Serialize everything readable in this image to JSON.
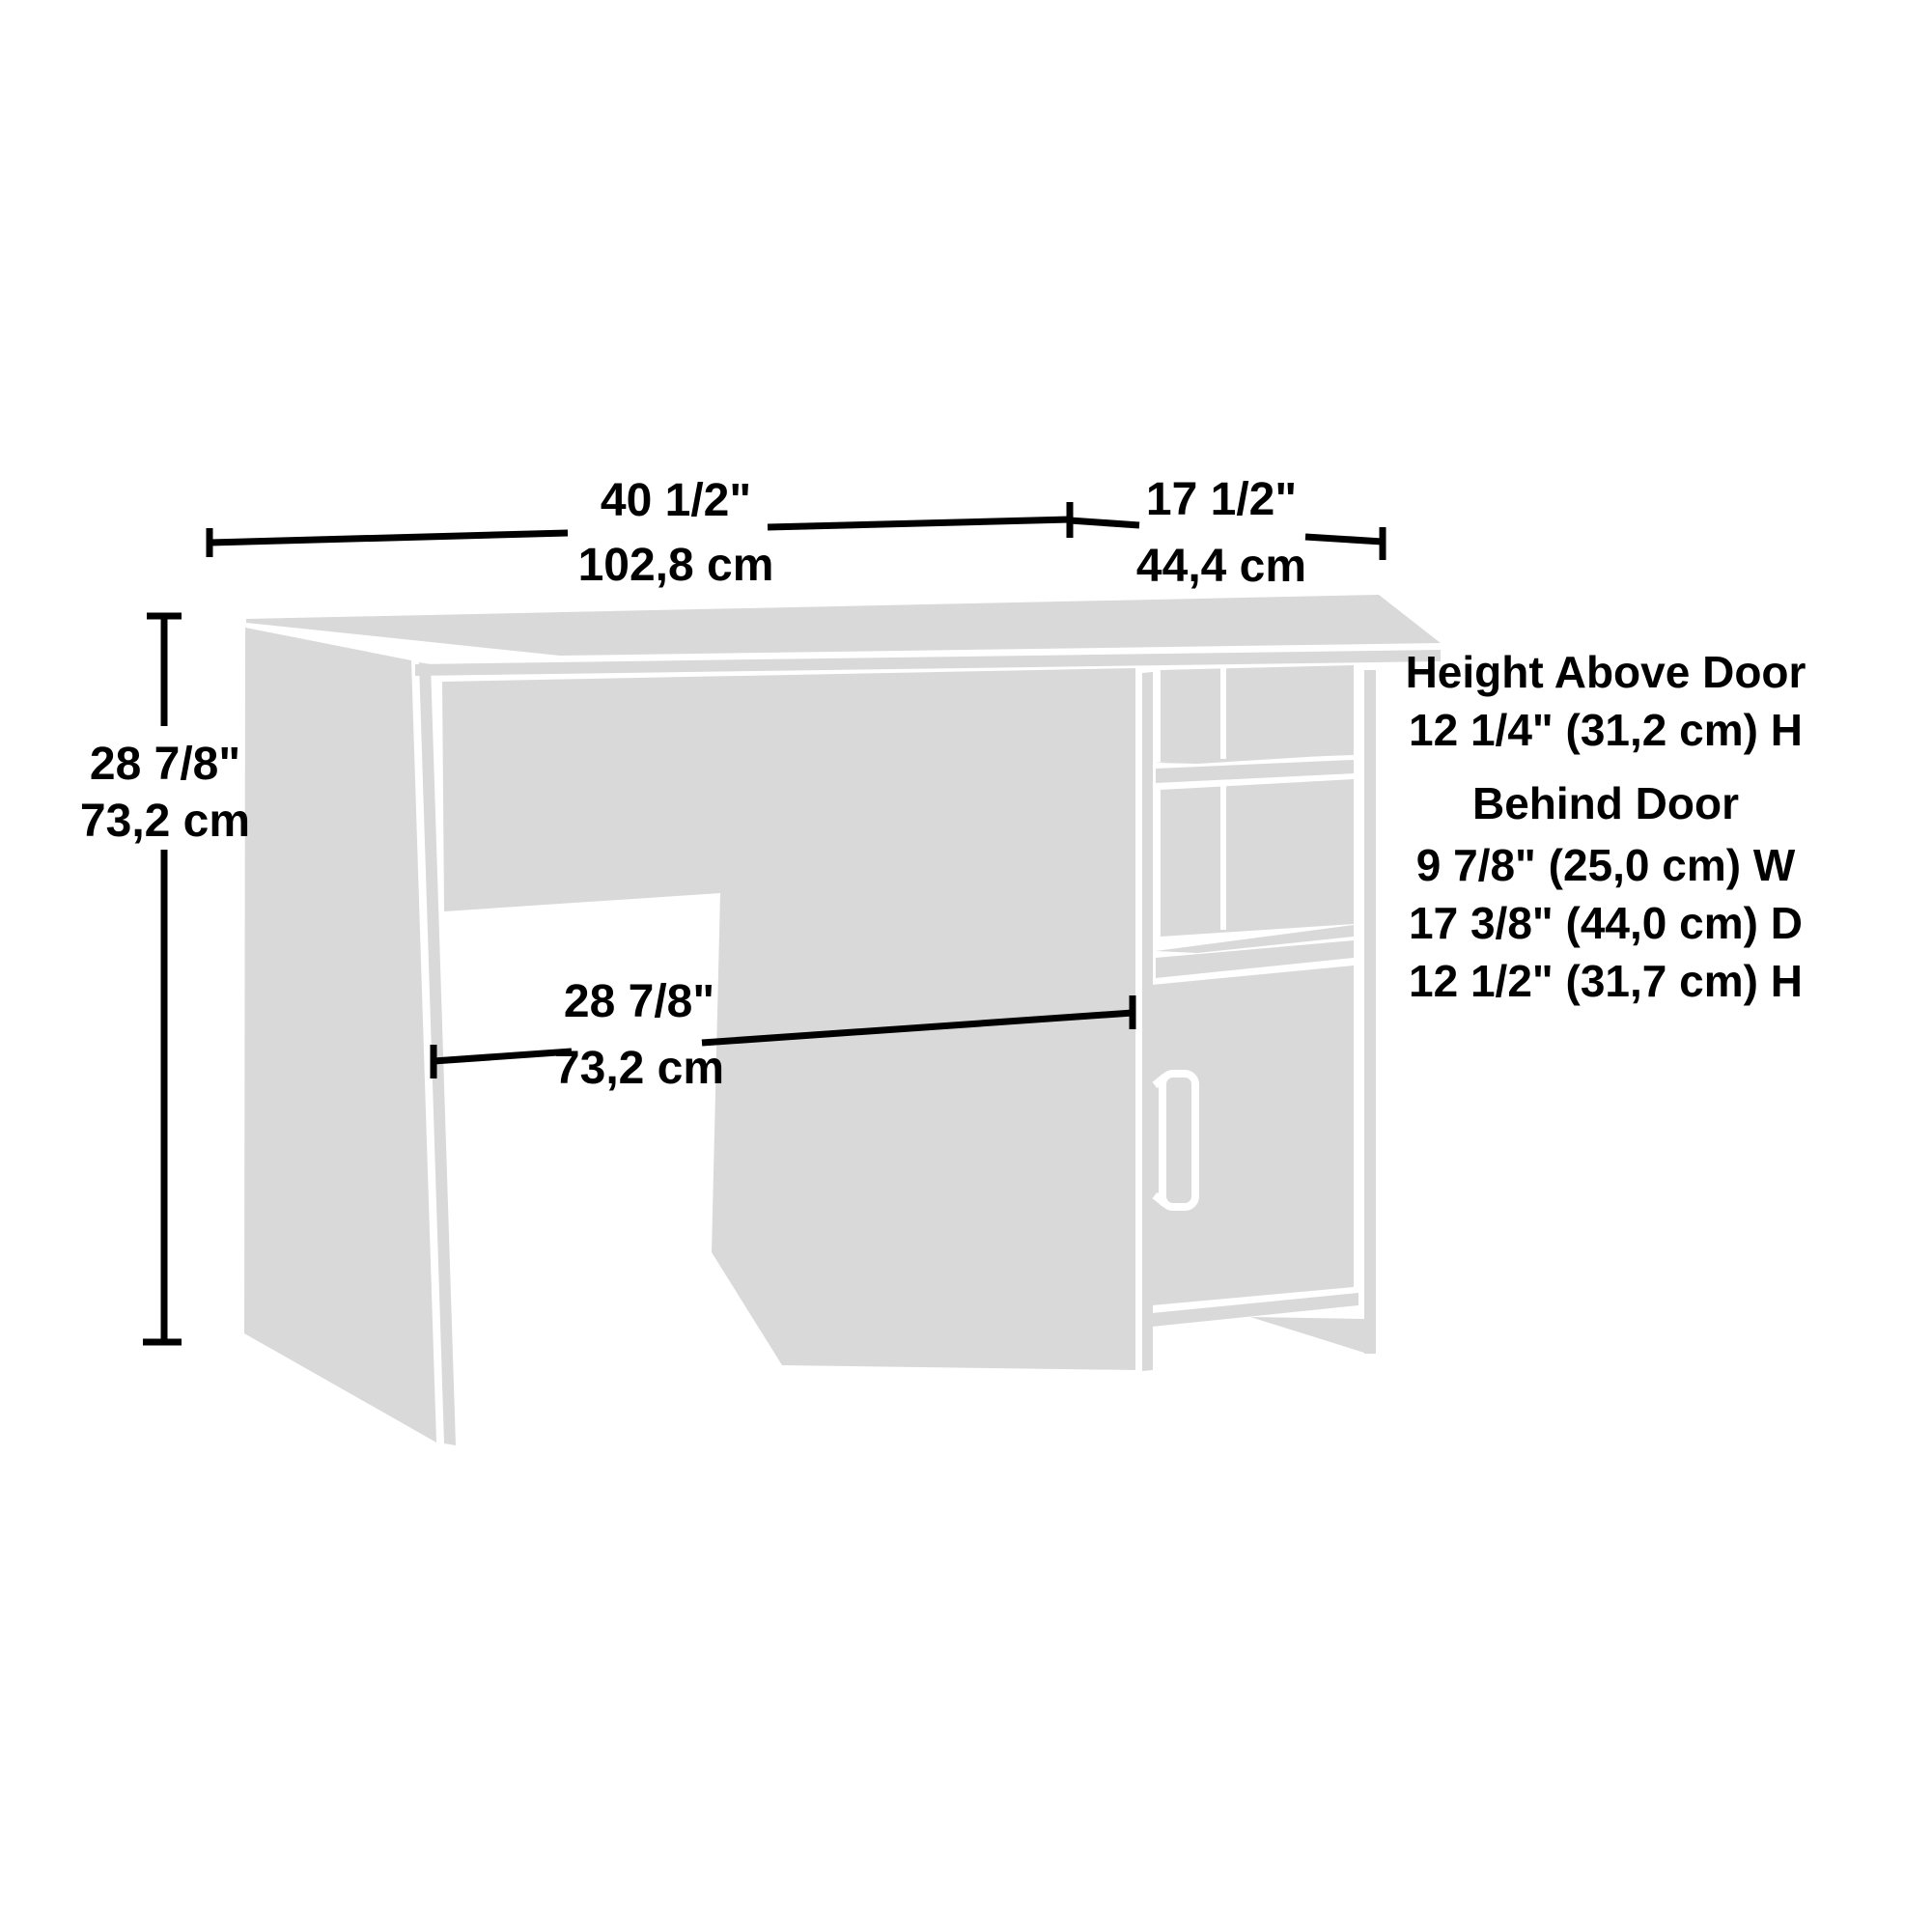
{
  "colors": {
    "panel": "#d9d9d9",
    "line": "#000000",
    "seam": "#ffffff",
    "background": "#ffffff"
  },
  "dimensions": {
    "top_width": {
      "inches": "40 1/2\"",
      "cm": "102,8 cm"
    },
    "top_depth": {
      "inches": "17 1/2\"",
      "cm": "44,4 cm"
    },
    "height": {
      "inches": "28 7/8\"",
      "cm": "73,2 cm"
    },
    "knee_space": {
      "inches": "28 7/8\"",
      "cm": "73,2 cm"
    }
  },
  "annotations": {
    "above_door_title": "Height Above Door",
    "above_door_height": "12 1/4\" (31,2 cm) H",
    "behind_door_title": "Behind Door",
    "behind_door_width": "9 7/8\" (25,0 cm) W",
    "behind_door_depth": "17 3/8\" (44,0 cm) D",
    "behind_door_height": "12 1/2\" (31,7 cm) H"
  }
}
